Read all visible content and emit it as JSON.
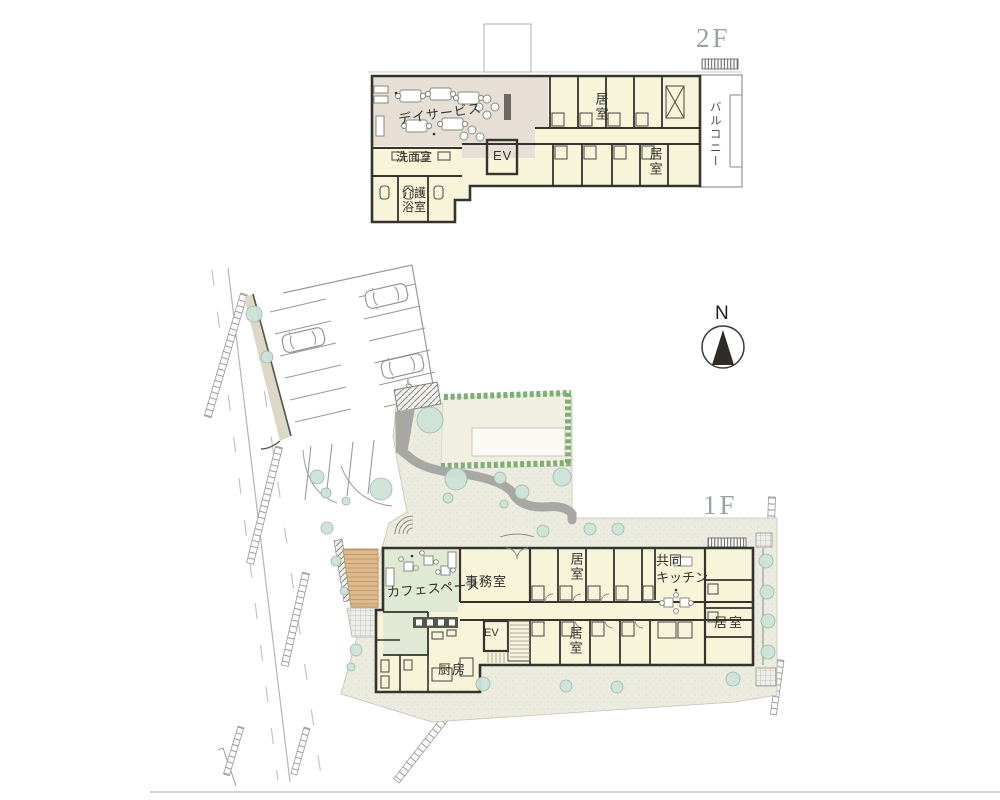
{
  "floor2": {
    "label": "2F",
    "day_service": "デイサービス",
    "washroom": "洗面室",
    "care_bath": "介護\n浴室",
    "elevator": "EV",
    "room_upper": "居室",
    "room_lower": "居室",
    "balcony": "バルコニー"
  },
  "floor1": {
    "label": "1F",
    "cafe": "カフェスペース",
    "office": "事務室",
    "elevator": "EV",
    "room_upper": "居室",
    "room_lower": "居室",
    "room_right": "居室",
    "shared_kitchen": "共同\nキッチン",
    "kitchen": "厨房"
  },
  "compass": {
    "north": "N"
  },
  "icons": {
    "accessible_parking": "accessible-parking-icon"
  },
  "palette": {
    "wall": "#34332d",
    "room_yellow": "#f7f4da",
    "dayservice_pink": "#e7dfd6",
    "cafe_green": "#dfe9d3",
    "pavement": "#ecebe0",
    "garden_cream": "#f1efe2",
    "deck_tan": "#dcba8e",
    "path_gray": "#a7a7a3",
    "tree_green": "#cfe3d8",
    "floor_label_gray": "#9aa3a0",
    "road_gray": "#b5b5b5",
    "text": "#32322c"
  }
}
